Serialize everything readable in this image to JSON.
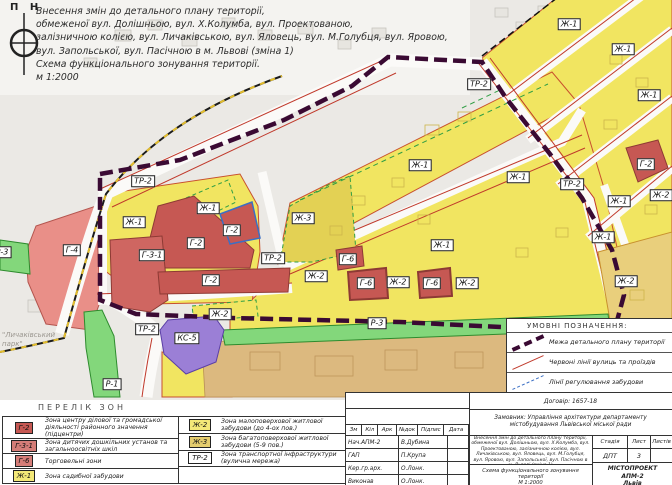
{
  "compass": {
    "label": "П Н"
  },
  "title": {
    "lines": [
      "Внесення змін до детального плану території,",
      "обмеженої вул. Долішньою, вул. Х.Колумба, вул. Проектованою,",
      "залізничною колією, вул. Личаківською, вул. Яловець, вул. М.Голубця, вул. Яровою,",
      "вул. Запольської, вул. Пасічною в м. Львові (зміна 1)",
      "Схема функціонального зонування території.",
      "м 1:2000"
    ]
  },
  "map": {
    "park_label": "\"Личаківський парк\"",
    "zone_labels": [
      {
        "text": "ТР-2",
        "x": 479,
        "y": 84
      },
      {
        "text": "Ж-1",
        "x": 569,
        "y": 24
      },
      {
        "text": "Ж-1",
        "x": 623,
        "y": 49
      },
      {
        "text": "Ж-1",
        "x": 649,
        "y": 95
      },
      {
        "text": "Г-2",
        "x": 646,
        "y": 164
      },
      {
        "text": "ТР-2",
        "x": 572,
        "y": 184
      },
      {
        "text": "Ж-2",
        "x": 661,
        "y": 195
      },
      {
        "text": "Ж-1",
        "x": 619,
        "y": 201
      },
      {
        "text": "Ж-1",
        "x": 518,
        "y": 177
      },
      {
        "text": "Ж-1",
        "x": 603,
        "y": 237
      },
      {
        "text": "Ж-2",
        "x": 626,
        "y": 281
      },
      {
        "text": "Ж-1",
        "x": 420,
        "y": 165
      },
      {
        "text": "Ж-3",
        "x": 303,
        "y": 218
      },
      {
        "text": "Ж-1",
        "x": 442,
        "y": 245
      },
      {
        "text": "Г-6",
        "x": 348,
        "y": 259
      },
      {
        "text": "Ж-2",
        "x": 316,
        "y": 276
      },
      {
        "text": "Г-6",
        "x": 366,
        "y": 283
      },
      {
        "text": "Ж-2",
        "x": 398,
        "y": 282
      },
      {
        "text": "Г-6",
        "x": 432,
        "y": 283
      },
      {
        "text": "Ж-2",
        "x": 467,
        "y": 283
      },
      {
        "text": "ТР-2",
        "x": 143,
        "y": 181
      },
      {
        "text": "Ж-1",
        "x": 134,
        "y": 222
      },
      {
        "text": "Ж-1",
        "x": 208,
        "y": 208
      },
      {
        "text": "Г-2",
        "x": 232,
        "y": 230
      },
      {
        "text": "Г-2",
        "x": 196,
        "y": 243
      },
      {
        "text": "Г-3-1",
        "x": 152,
        "y": 255
      },
      {
        "text": "ТР-2",
        "x": 273,
        "y": 258
      },
      {
        "text": "Г-2",
        "x": 211,
        "y": 280
      },
      {
        "text": "Ж-2",
        "x": 220,
        "y": 314
      },
      {
        "text": "Г-4",
        "x": 72,
        "y": 250
      },
      {
        "text": "Р-3",
        "x": 2,
        "y": 252
      },
      {
        "text": "ТР-2",
        "x": 147,
        "y": 329
      },
      {
        "text": "КС-5",
        "x": 187,
        "y": 338
      },
      {
        "text": "Р-1",
        "x": 112,
        "y": 384
      },
      {
        "text": "Р-3",
        "x": 377,
        "y": 323
      }
    ]
  },
  "zone_list": {
    "title": "ПЕРЕЛІК ЗОН",
    "items": [
      {
        "code": "Г-2",
        "color": "#c65853",
        "desc": "Зона центру ділової та громадської діяльності районного значення (підцентри)"
      },
      {
        "code": "Г-3-1",
        "color": "#d57d78",
        "desc": "Зона дитячих дошкільних установ та загальноосвітніх шкіл"
      },
      {
        "code": "Г-6",
        "color": "#d57d78",
        "desc": "Торговельні зони"
      },
      {
        "code": "Ж-1",
        "color": "#f3e878",
        "desc": "Зона садибної забудови"
      },
      {
        "code": "Ж-2",
        "color": "#f3e878",
        "desc": "Зона малоповерхової житлової забудови (до 4-ох пов.)"
      },
      {
        "code": "Ж-3",
        "color": "#e5cd6e",
        "desc": "Зона багатоповерхової житлової забудови (5-9 пов.)"
      },
      {
        "code": "ТР-2",
        "color": "#ffffff",
        "desc": "Зона транспортної інфраструктури (вулична мережа)"
      }
    ]
  },
  "symbols": {
    "title": "УМОВНІ ПОЗНАЧЕННЯ:",
    "items": [
      {
        "name": "boundary",
        "desc": "Межа детального плану території"
      },
      {
        "name": "red-lines",
        "desc": "Червоні лінії вулиць та проїздів"
      },
      {
        "name": "regulation-lines",
        "desc": "Лінії регулювання забудови"
      }
    ]
  },
  "title_block": {
    "contract": "Договір: 1657-18",
    "client": "Замовник: Управління архітектури департаменту містобудування Львівської міської ради",
    "sign_cols": [
      "Зм",
      "Кіл",
      "Арк",
      "№док",
      "Підпис",
      "Дата"
    ],
    "sign_rows": [
      {
        "role": "Нач.АПМ-2",
        "name": "В.Дубина"
      },
      {
        "role": "ГАП",
        "name": "П.Крупа"
      },
      {
        "role": "Кер.гр.арх.",
        "name": "О.Лонк."
      },
      {
        "role": "Виконав",
        "name": "О.Лонк."
      }
    ],
    "project_desc": "Внесення змін до детального плану території, обмеженої вул. Долішньою, вул. Х.Колумба, вул. Проектованою, залізничною колією, вул. Личаківською, вул. Яловець, вул. М.Голубця, вул. Яровою, вул. Запольської, вул. Пасічною в м. Львові (зміна 1)",
    "sheet_title": "Схема функціонального зонування території",
    "scale": "М 1:2000",
    "stage_cols": [
      "Стадія",
      "Лист",
      "Листів"
    ],
    "stage": "ДПТ",
    "sheet": "3",
    "org_lines": [
      "МІСТОПРОЕКТ",
      "АПМ-2",
      "Львів"
    ]
  }
}
